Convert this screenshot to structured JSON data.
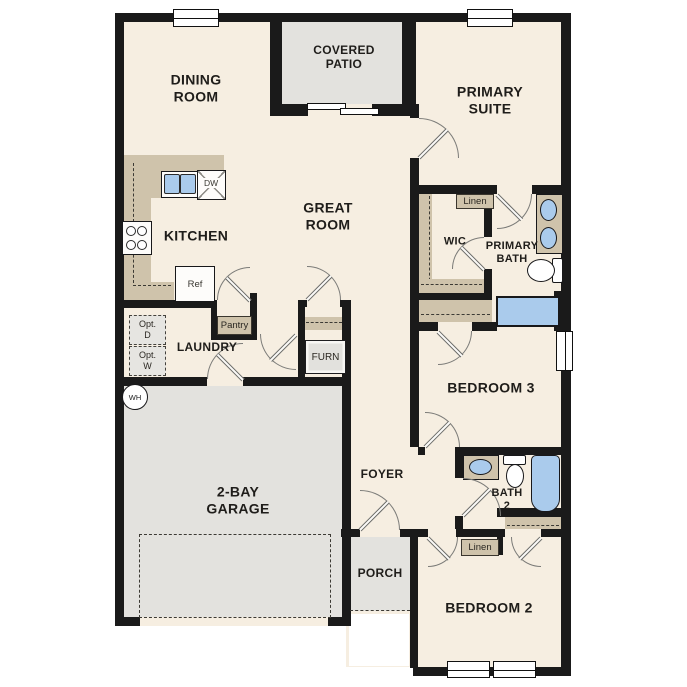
{
  "plan_title": "single-story floor plan",
  "colors": {
    "wall": "#1a1a1a",
    "floor": "#f6eee1",
    "hardscape": "#e3e2de",
    "counter": "#cfc3ab",
    "water": "#aacbec"
  },
  "rooms": {
    "dining_room": "DINING\nROOM",
    "covered_patio": "COVERED\nPATIO",
    "primary_suite": "PRIMARY\nSUITE",
    "kitchen": "KITCHEN",
    "great_room": "GREAT\nROOM",
    "wic": "WIC",
    "primary_bath": "PRIMARY\nBATH",
    "laundry": "LAUNDRY",
    "bedroom_3": "BEDROOM 3",
    "garage": "2-BAY\nGARAGE",
    "foyer": "FOYER",
    "bath_2": "BATH\n2",
    "porch": "PORCH",
    "bedroom_2": "BEDROOM 2"
  },
  "closets": {
    "pantry": "Pantry",
    "linen_primary": "Linen",
    "linen_hall": "Linen"
  },
  "appliances": {
    "dishwasher": "DW",
    "refrigerator": "Ref",
    "furnace": "FURN",
    "water_heater": "WH",
    "optional_dryer": "Opt.\nD",
    "optional_washer": "Opt.\nW"
  }
}
